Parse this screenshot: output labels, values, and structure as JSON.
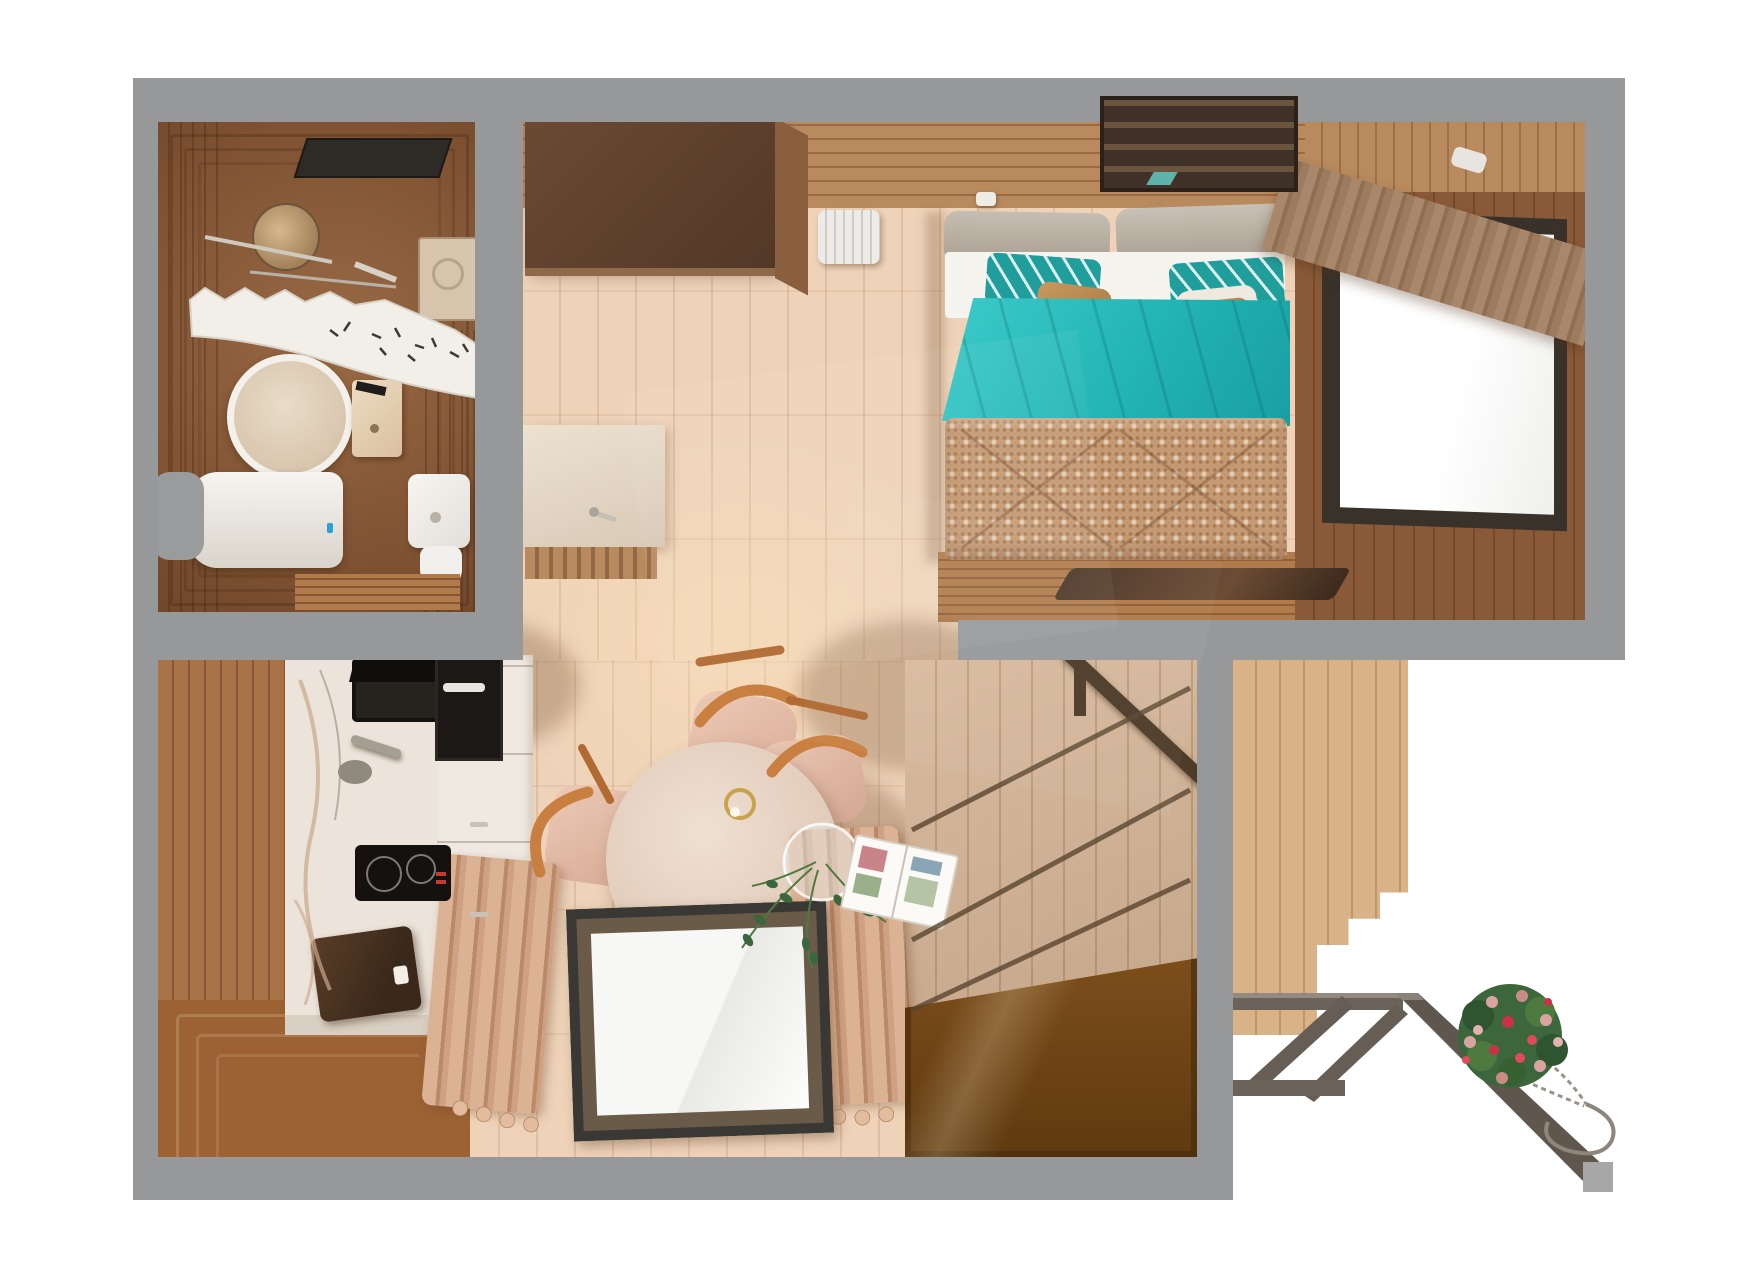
{
  "scene": {
    "description": "photorealistic top-down 3D render of a tiny-house floor plan",
    "background": "#ffffff",
    "no_visible_text": true
  },
  "palette": {
    "wall": "#97989a",
    "wallLight": "#a8a9ab",
    "floor": "#eed3b9",
    "woodMed": "#b98a5e",
    "woodDark": "#8a5a38",
    "slatBrown": "#a97348",
    "bathBase": "#9a6a45",
    "bathDark": "#71472a",
    "marble": "#ece4da",
    "teal": "#2ec0bf",
    "tealDark": "#179d9e",
    "quilt": "#c59a73",
    "blush": "#e6c0ac",
    "chairWood": "#c87f3f",
    "amberTop": "#a86c2c",
    "amberDeep": "#5f3a10",
    "truss": "#655c52",
    "deck": "#d9b288",
    "windowFrame": "#38322b",
    "pane": "#fbfbfa",
    "curtain": "#9c7b5e",
    "cream": "#efe9e2",
    "applianceDark": "#1b1815",
    "leaf": "#3c663c",
    "flowerPink": "#d9a3a0",
    "flowerRed": "#cc3247",
    "chrome": "#c6c0b4",
    "benchWood": "#b07a4a",
    "rugDark": "#503823",
    "cushionGray": "#bdb5aa",
    "closetDark": "#5f4231"
  },
  "rooms": [
    {
      "name": "bathroom",
      "items": [
        "ceiling-vent",
        "shower-head",
        "shower-rail",
        "shower-curtain",
        "shower-tray",
        "round-mirror",
        "wall-sink",
        "black-faucet",
        "toilet",
        "water-boiler",
        "gray-mat",
        "wood-mat"
      ]
    },
    {
      "name": "entry-hall",
      "items": [
        "dark-closet",
        "radiator",
        "wall-console-panel"
      ]
    },
    {
      "name": "bedroom",
      "items": [
        "wall-shelf",
        "double-bed",
        "headboard-cushions",
        "teal-striped-pillows",
        "tan-pillows",
        "teal-duvet",
        "patterned-quilt",
        "foot-bench",
        "dark-tray-rug",
        "picture-window",
        "pleated-curtain",
        "slat-wall"
      ]
    },
    {
      "name": "kitchen-living",
      "items": [
        "slat-accent-wall",
        "marble-counter",
        "black-sink",
        "faucet",
        "induction-cooktop",
        "coffee-machine",
        "oven",
        "white-cabinets",
        "round-dining-table",
        "pendant-ring-lamp",
        "glass-vase-plant",
        "open-magazine",
        "dining-chairs",
        "ribbed-loungers",
        "glass-floor-panel",
        "stairwell-glass",
        "stair-railing"
      ]
    },
    {
      "name": "exterior",
      "items": [
        "deck-plank-wall",
        "gray-truss",
        "column-cap",
        "hanging-flower-basket",
        "basket-chain-hook"
      ]
    }
  ]
}
